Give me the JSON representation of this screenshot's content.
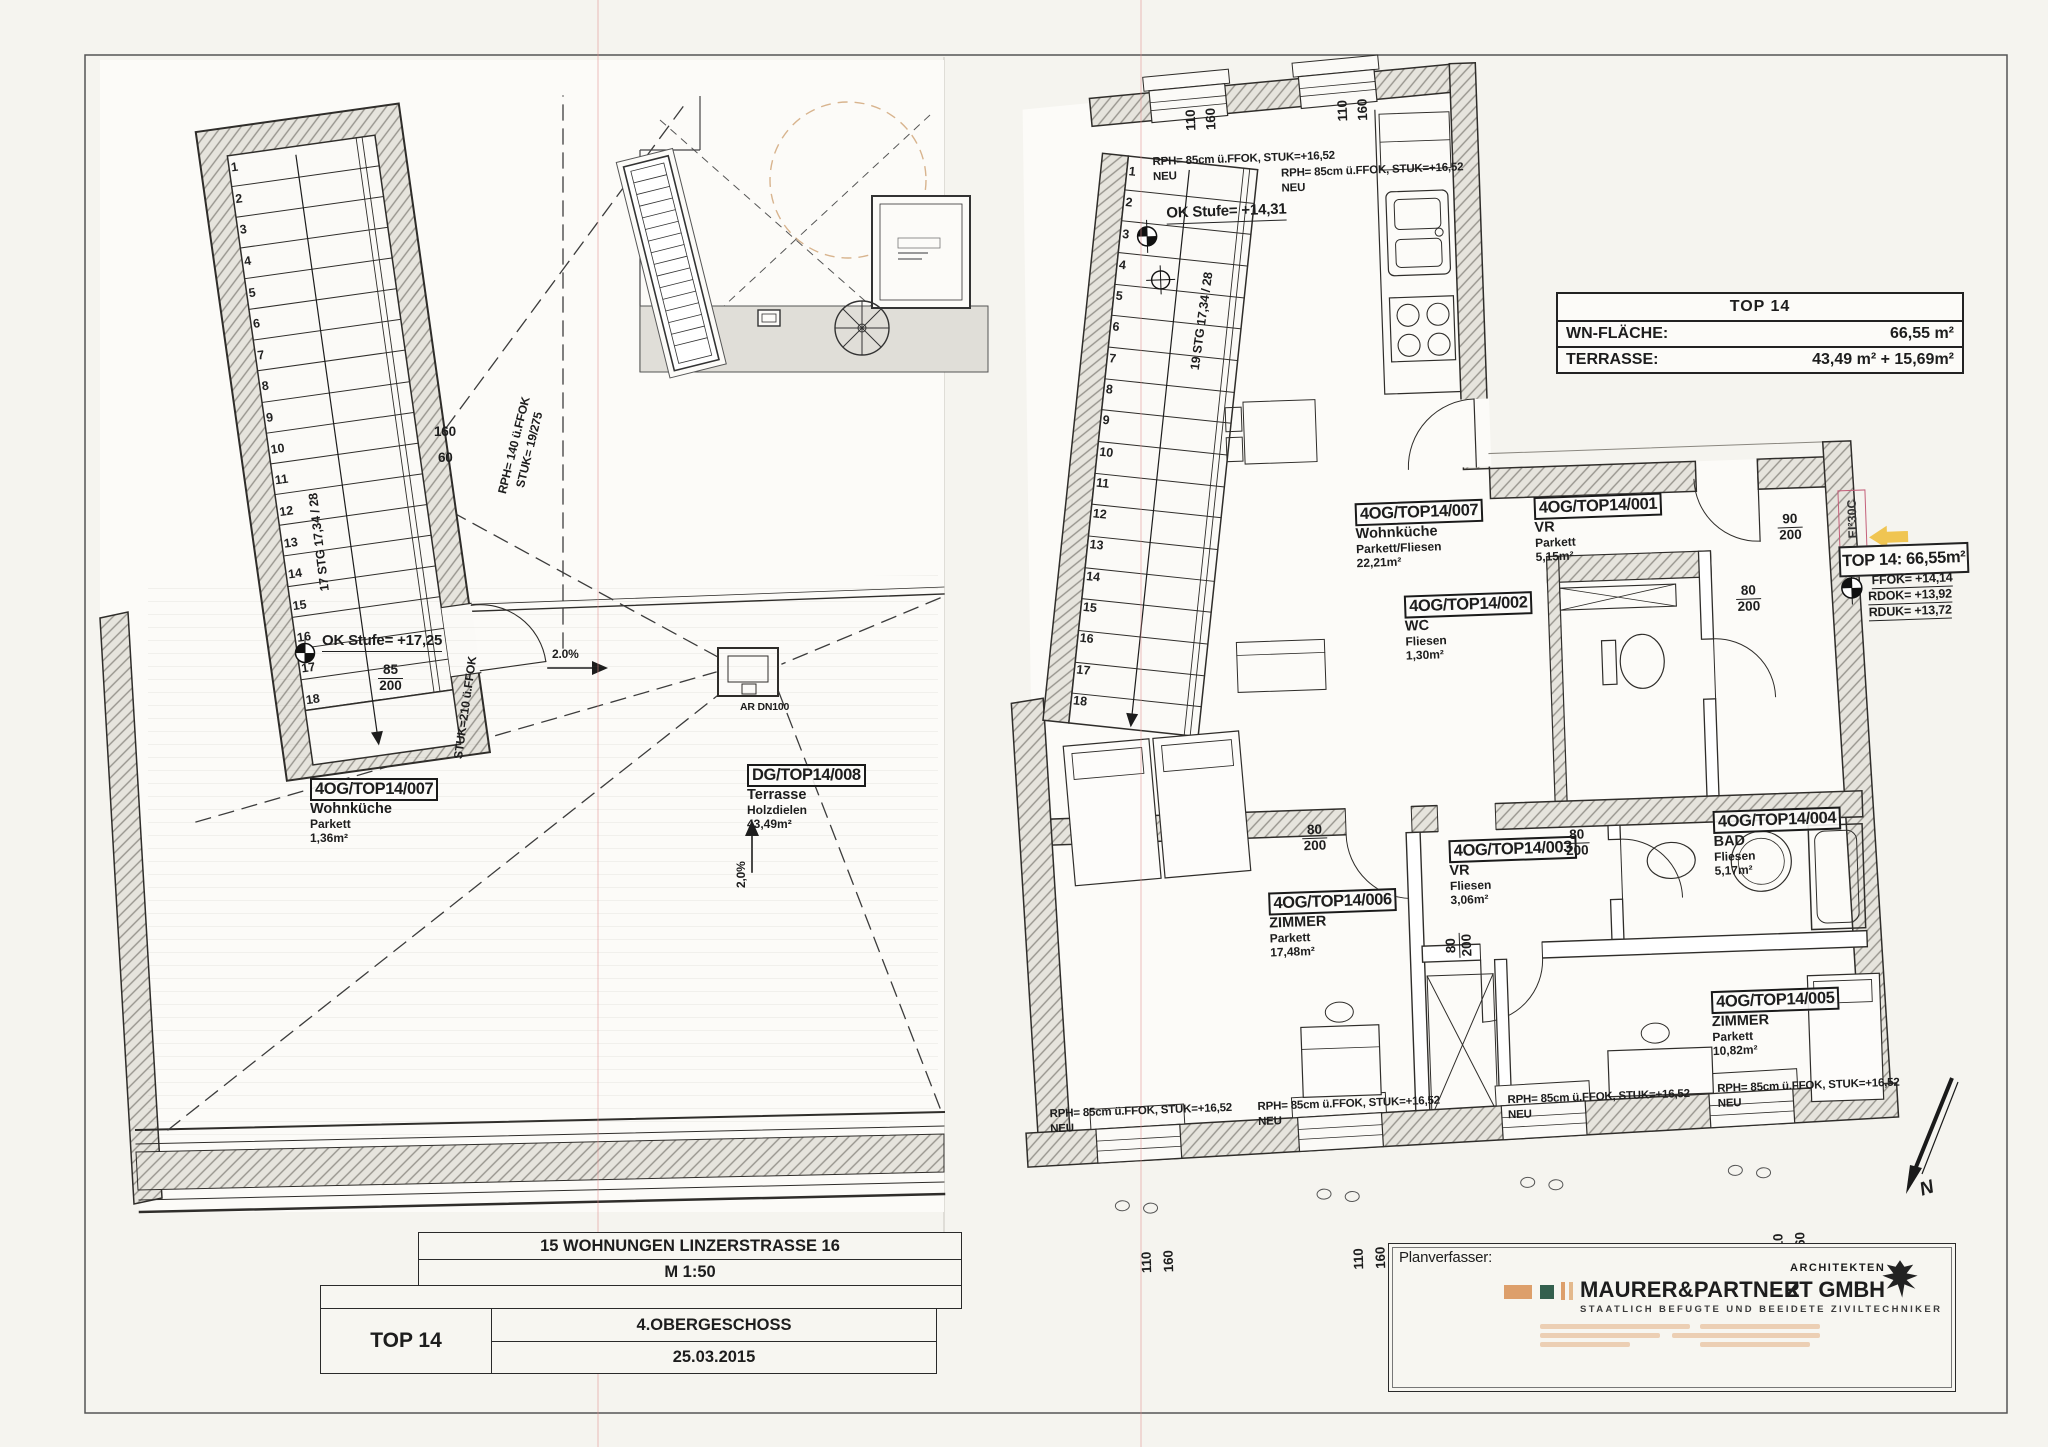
{
  "sheet": {
    "project": "15 WOHNUNGEN LINZERSTRASSE 16",
    "scale": "M 1:50",
    "unit": "TOP 14",
    "floor": "4.OBERGESCHOSS",
    "date": "25.03.2015",
    "planner_label": "Planverfasser:"
  },
  "summary": {
    "title": "TOP 14",
    "rows": [
      {
        "label": "WN-FLÄCHE:",
        "value": "66,55 m²"
      },
      {
        "label": "TERRASSE:",
        "value": "43,49 m² + 15,69m²"
      }
    ]
  },
  "firm": {
    "architekten": "ARCHITEKTEN",
    "name": "MAURER&PARTNER",
    "suffix": "ZT GMBH",
    "subtitle": "STAATLICH BEFUGTE UND BEEIDETE ZIVILTECHNIKER"
  },
  "rooms": [
    {
      "code": "4OG/TOP14/007",
      "name": "Wohnküche",
      "material": "Parkett",
      "area": "1,36m²"
    },
    {
      "code": "DG/TOP14/008",
      "name": "Terrasse",
      "material": "Holzdielen",
      "area": "43,49m²"
    },
    {
      "code": "4OG/TOP14/007",
      "name": "Wohnküche",
      "material": "Parkett/Fliesen",
      "area": "22,21m²"
    },
    {
      "code": "4OG/TOP14/001",
      "name": "VR",
      "material": "Parkett",
      "area": "5,15m²"
    },
    {
      "code": "4OG/TOP14/002",
      "name": "WC",
      "material": "Fliesen",
      "area": "1,30m²"
    },
    {
      "code": "4OG/TOP14/003",
      "name": "VR",
      "material": "Fliesen",
      "area": "3,06m²"
    },
    {
      "code": "4OG/TOP14/004",
      "name": "BAD",
      "material": "Fliesen",
      "area": "5,17m²"
    },
    {
      "code": "4OG/TOP14/006",
      "name": "ZIMMER",
      "material": "Parkett",
      "area": "17,48m²"
    },
    {
      "code": "4OG/TOP14/005",
      "name": "ZIMMER",
      "material": "Parkett",
      "area": "10,82m²"
    }
  ],
  "stairs": {
    "numbers": [
      "1",
      "2",
      "3",
      "4",
      "5",
      "6",
      "7",
      "8",
      "9",
      "10",
      "11",
      "12",
      "13",
      "14",
      "15",
      "16",
      "17",
      "18"
    ],
    "left_text": "17 STG  17,34 / 28",
    "right_text": "19 STG  17,34 / 28"
  },
  "annotations": {
    "ok_stufe_left": "OK Stufe= +17,25",
    "ok_stufe_right": "OK Stufe= +14,31",
    "window_note": "RPH= 85cm ü.FFOK, STUK=+16,52",
    "neu": "NEU",
    "rph140": "RPH= 140 ü.FFOK",
    "stuk19": "STUK= 19/275",
    "stuk210": "STUK=210 ü.FFOK",
    "dim160": "160",
    "dim60": "60",
    "dim110": "110",
    "slope": "2.0%",
    "slope_v": "2,0%",
    "drain": "AR DN100",
    "d85": "85",
    "d80": "80",
    "d90": "90",
    "d200": "200",
    "ei": "EI²30C",
    "top14_area": "TOP 14: 66,55m²",
    "ffok": "FFOK= +14,14",
    "rdok": "RDOK= +13,92",
    "rduk": "RDUK= +13,72",
    "north": "N"
  }
}
